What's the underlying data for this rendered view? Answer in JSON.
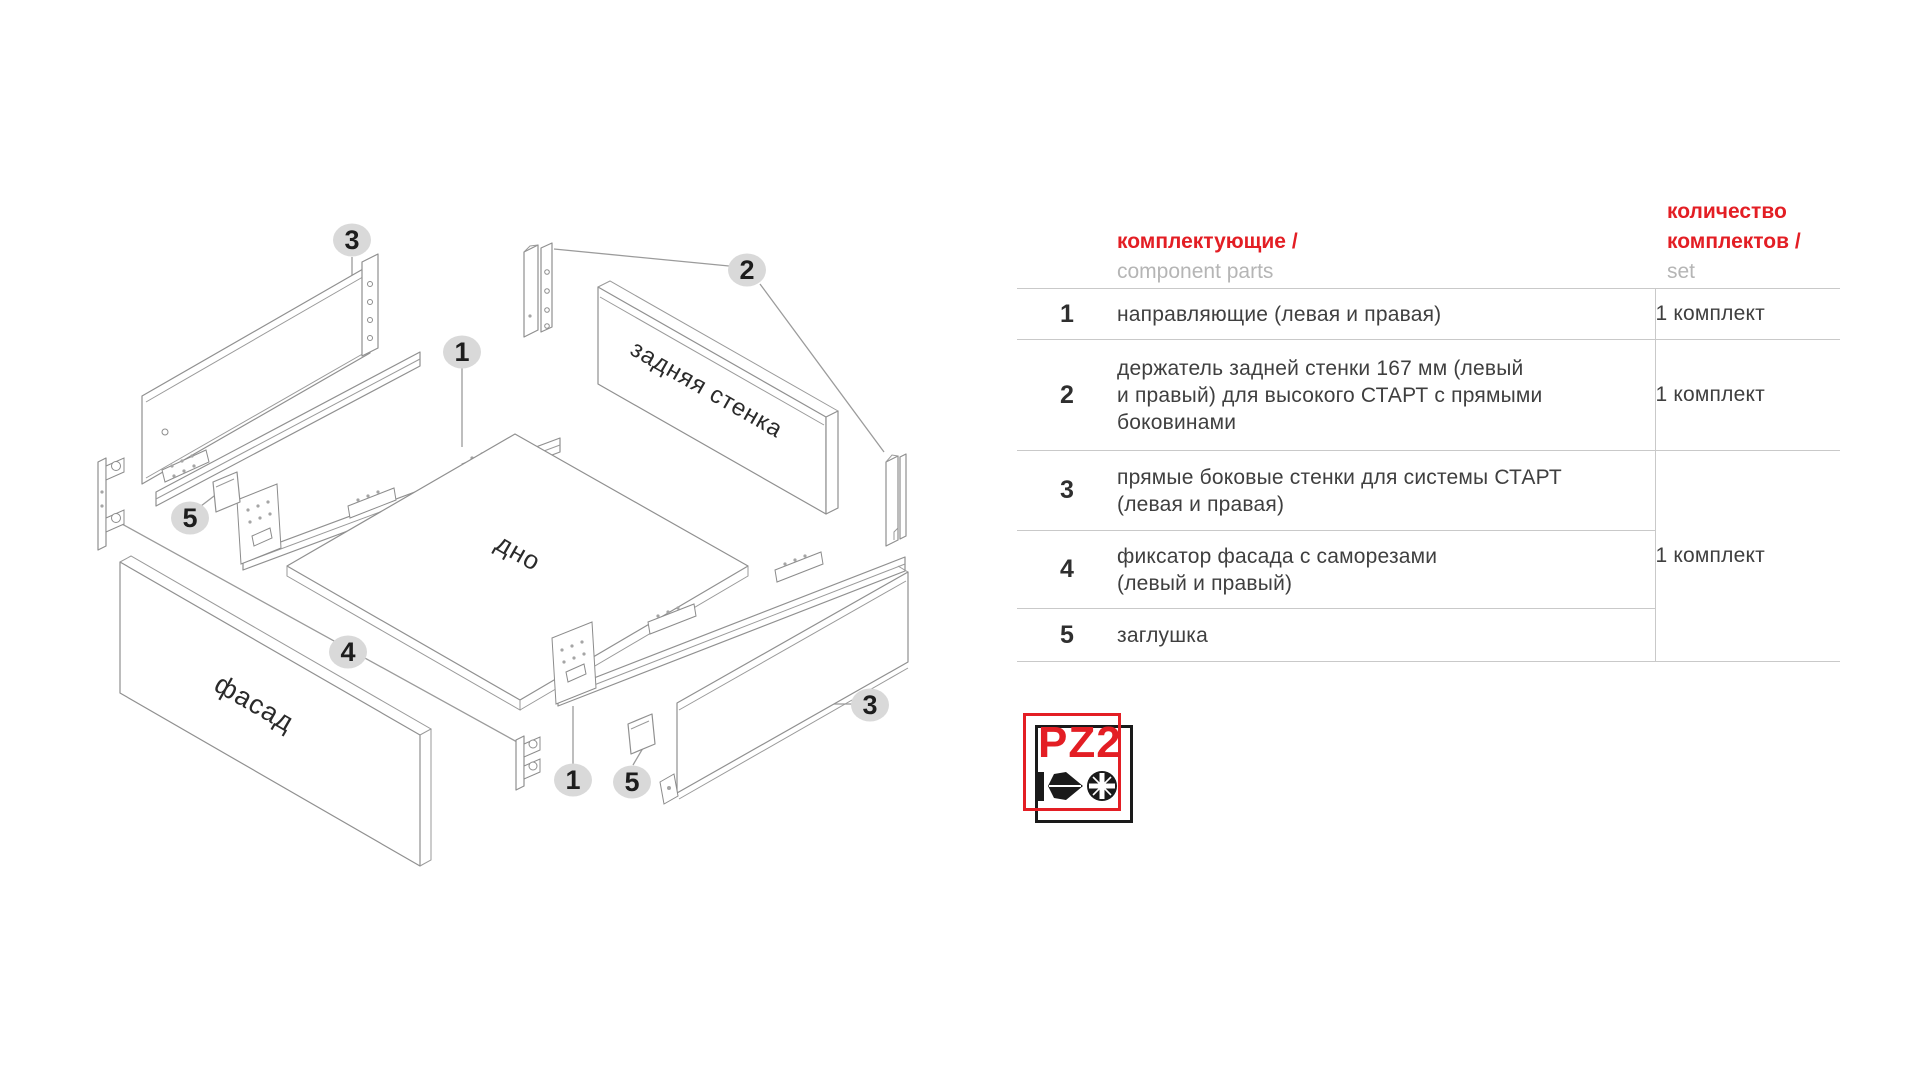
{
  "table": {
    "header": {
      "parts_ru": "комплектующие /",
      "parts_en": "component parts",
      "qty_ru": "количество\nкомплектов /",
      "qty_en": "set"
    },
    "rows": [
      {
        "num": "1",
        "text": "направляющие (левая и правая)",
        "qty": "1 комплект"
      },
      {
        "num": "2",
        "text": "держатель задней стенки 167 мм (левый\nи правый) для высокого СТАРТ с прямыми\nбоковинами",
        "qty": "1 комплект"
      },
      {
        "num": "3",
        "text": "прямые боковые стенки для системы СТАРТ\n(левая и правая)"
      },
      {
        "num": "4",
        "text": "фиксатор фасада с саморезами\n(левый и правый)"
      },
      {
        "num": "5",
        "text": "заглушка"
      }
    ],
    "merged_qty": "1 комплект"
  },
  "diagram": {
    "labels": {
      "back_wall": "задняя стенка",
      "bottom": "дно",
      "front": "фасад"
    },
    "callouts": {
      "side_left": "3",
      "holders": "2",
      "rail_top": "1",
      "plug_left": "5",
      "front_fix": "4",
      "side_right": "3",
      "rail_bottom": "1",
      "plug_right": "5"
    }
  },
  "logo": {
    "text": "PZ2",
    "tool": "pozidriv-screwdriver"
  },
  "colors": {
    "accent_red": "#e31e24",
    "callout_fill": "#d9d9d9",
    "line_gray": "#909090"
  }
}
